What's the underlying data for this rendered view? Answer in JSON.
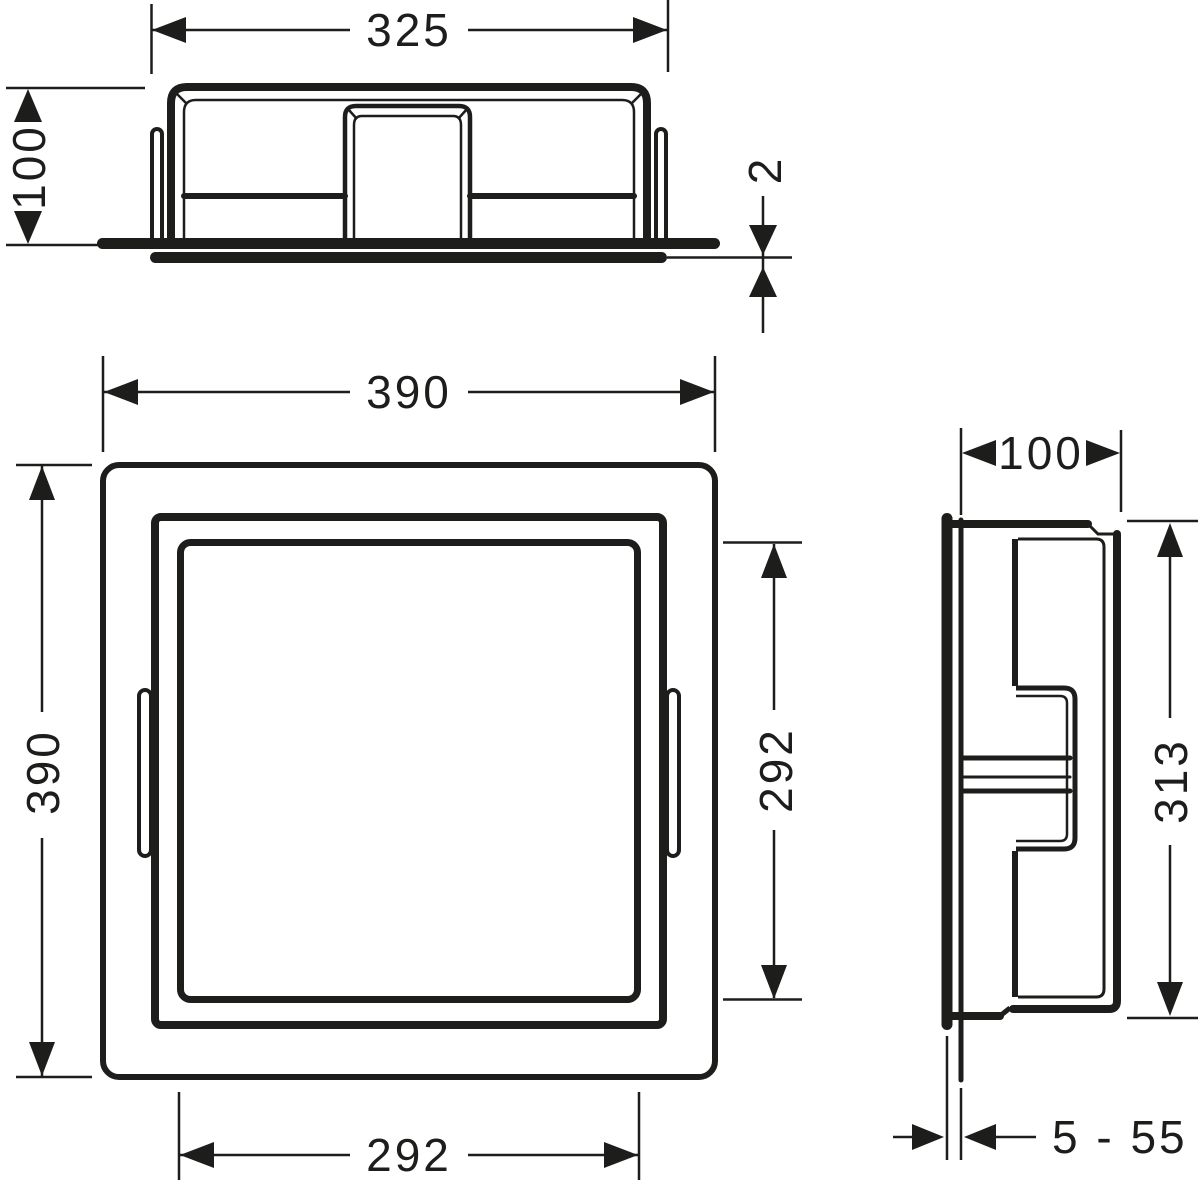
{
  "drawing": {
    "background": "#ffffff",
    "line_color": "#1d1d1b",
    "views": {
      "top": {
        "dims": {
          "width": "325",
          "height": "100",
          "lip_thickness": "2"
        }
      },
      "front": {
        "dims": {
          "frame_width": "390",
          "frame_height": "390",
          "cutout_width": "292",
          "cutout_height": "292"
        }
      },
      "side": {
        "dims": {
          "depth": "100",
          "body_height": "313",
          "tile_adjust_range": "5 - 55"
        }
      }
    }
  }
}
